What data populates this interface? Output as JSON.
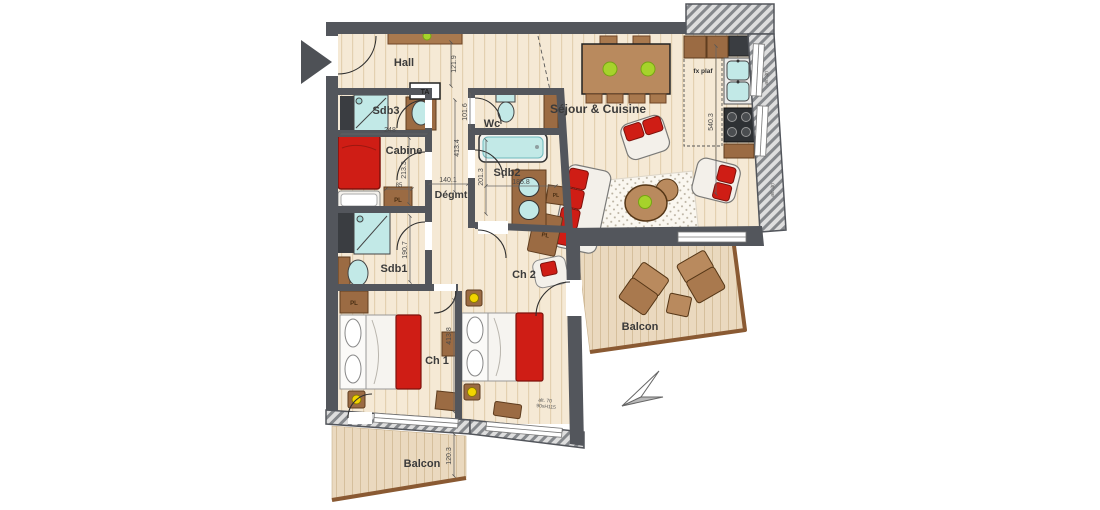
{
  "plan": {
    "rooms": {
      "hall": "Hall",
      "sdb3": "Sdb3",
      "cabine": "Cabine",
      "sdb1": "Sdb1",
      "wc": "Wc",
      "sdb2": "Sdb2",
      "degagement": "Dégmt",
      "sejour_cuisine": "Séjour & Cuisine",
      "ch1": "Ch 1",
      "ch2": "Ch 2",
      "balcon_est": "Balcon",
      "balcon_sud": "Balcon"
    },
    "annotations": {
      "fx_plaf": "fx plaf",
      "ta": "TA",
      "pl": "PL",
      "window_alt": "alt. 70",
      "window_size": "90xH115",
      "right_wall_note_1": "alt. 30",
      "right_wall_note_2": "alt. 30"
    },
    "dimensions_cm": {
      "hall_passage": "121.9",
      "couloir_haut": "413.4",
      "wc": "101.6",
      "sdb2_profondeur": "201.3",
      "sdb2_largeur": "185.8",
      "degmt_largeur": "140.1",
      "cabine_largeur": "248",
      "cabine_profondeur": "213.3",
      "placard": "85",
      "sdb1_profondeur": "190.7",
      "ch1_longueur": "413.8",
      "cuisine_longueur": "540.3",
      "balcon_profondeur": "120.3"
    },
    "colors": {
      "wall": "#53565c",
      "floor": "#f5e9d5",
      "balcony_floor": "#ead9bf",
      "wood": "#a9794e",
      "wood_light": "#b98a5e",
      "accent_red": "#cf1d15",
      "sanitary_teal": "#c2e9e7",
      "plant_green": "#a6d32b",
      "lamp_yellow": "#f2d400"
    }
  }
}
